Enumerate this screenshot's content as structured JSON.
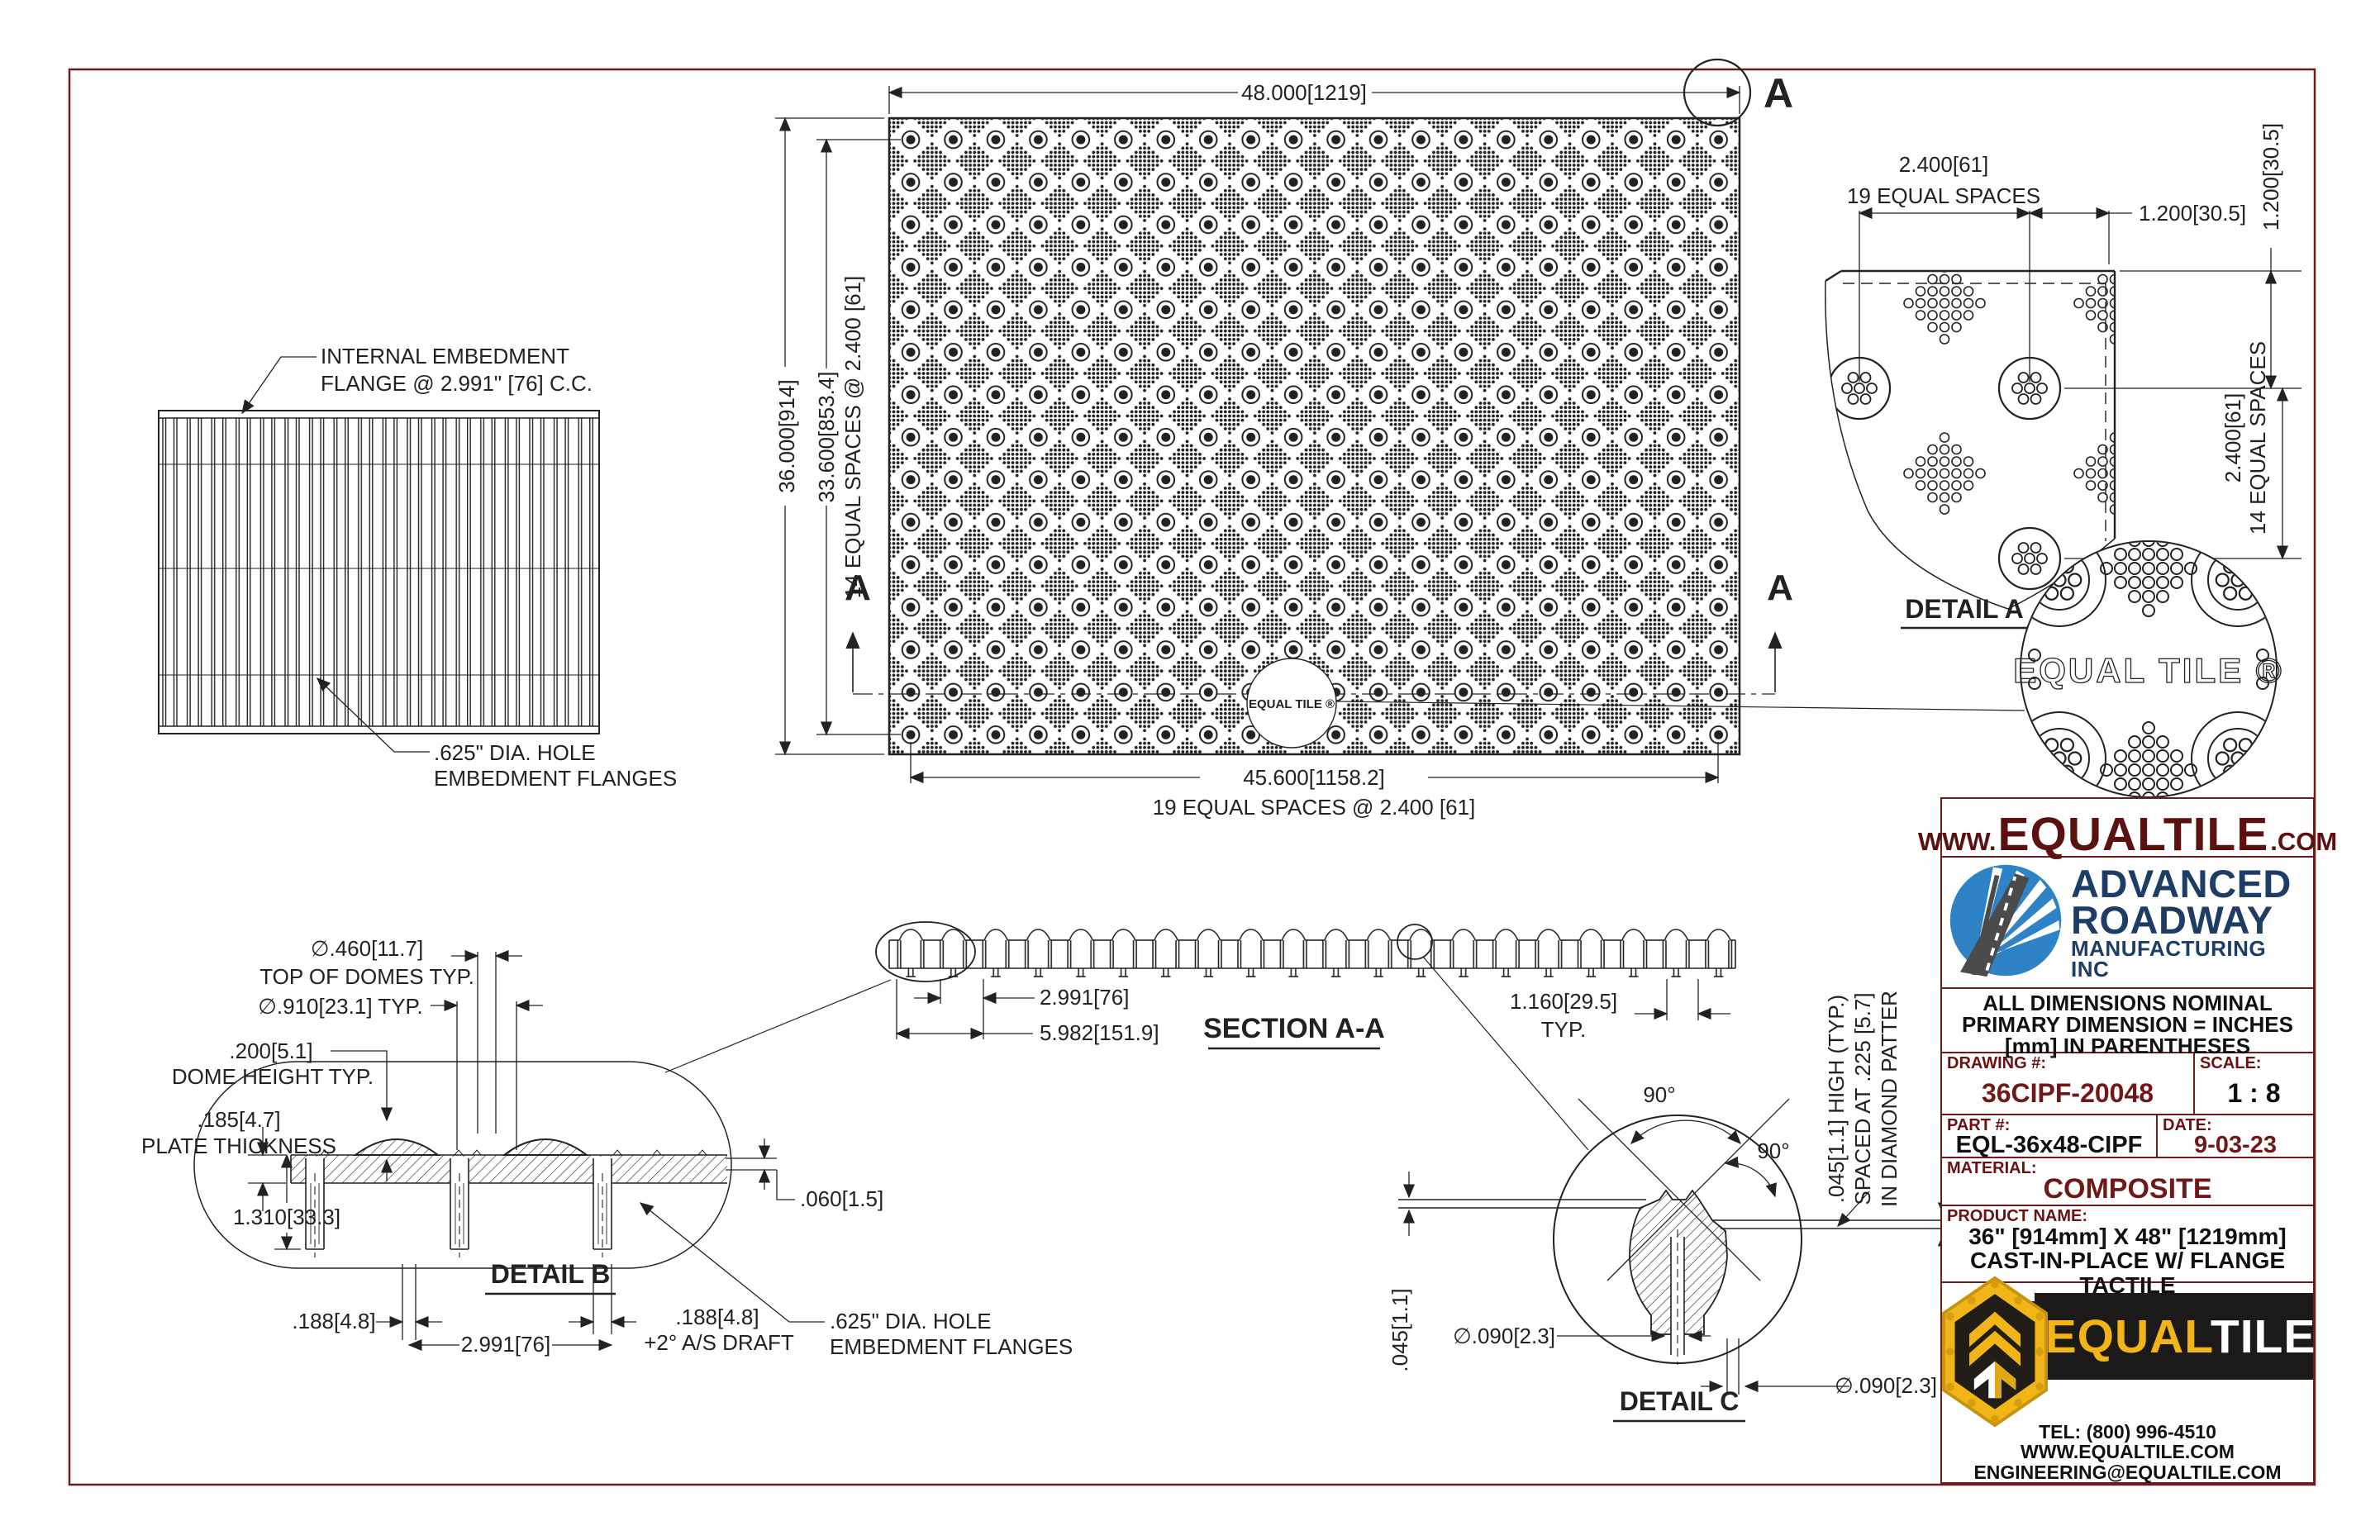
{
  "colors": {
    "sheet_border": "#6e1b1b",
    "line": "#222222",
    "url_red": "#5c1111",
    "value_red": "#701717",
    "navy": "#1d3c66",
    "logo_blue": "#2d83c5",
    "brand_yellow": "#f2b517",
    "banner_black": "#1c1a18"
  },
  "side_view": {
    "note1": "INTERNAL EMBEDMENT",
    "note2": "FLANGE @ 2.991\" [76] C.C.",
    "hole1": ".625\" DIA. HOLE",
    "hole2": "EMBEDMENT FLANGES"
  },
  "plan": {
    "width": "48.000[1219]",
    "height": "36.000[914]",
    "height_inner": "33.600[853.4]",
    "v_spaces": "14 EQUAL SPACES @ 2.400 [61]",
    "width_inner": "45.600[1158.2]",
    "h_spaces": "19 EQUAL SPACES @ 2.400 [61]",
    "marker": "A",
    "logo_stamp": "EQUAL TILE ®"
  },
  "detail_a": {
    "title": "DETAIL A",
    "pitch": "2.400[61]",
    "spaces19": "19 EQUAL SPACES",
    "offset": "1.200[30.5]",
    "offset_v": "1.200[30.5]",
    "pitch_v": "2.400[61]",
    "spaces14": "14 EQUAL SPACES"
  },
  "logo_detail": {
    "text": "EQUAL TILE ®"
  },
  "section_aa": {
    "title": "SECTION A-A",
    "dim_pitch": "2.991[76]",
    "dim_double": "5.982[151.9]",
    "dim_gap": "1.160[29.5]",
    "typ": "TYP."
  },
  "detail_b": {
    "title": "DETAIL B",
    "dome_top": "∅.460[11.7]",
    "dome_top_note": "TOP OF DOMES TYP.",
    "dome_base": "∅.910[23.1] TYP.",
    "dome_h": ".200[5.1]",
    "dome_h_note": "DOME HEIGHT TYP.",
    "plate": ".185[4.7]",
    "plate_note": "PLATE THICKNESS",
    "depth": "1.310[33.3]",
    "step": ".060[1.5]",
    "flange_t": ".188[4.8]",
    "pitch": "2.991[76]",
    "flange_t2": ".188[4.8]",
    "draft": "+2° A/S DRAFT",
    "hole1": ".625\" DIA. HOLE",
    "hole2": "EMBEDMENT FLANGES"
  },
  "detail_c": {
    "title": "DETAIL C",
    "angle1": "90°",
    "angle2": "90°",
    "height": ".045[1.1]",
    "dia1": "∅.090[2.3]",
    "dia2": "∅.090[2.3]",
    "rot1": ".045[1.1] HIGH (TYP.)",
    "rot2": "SPACED AT .225 [5.7]",
    "rot3": "IN DIAMOND PATTER"
  },
  "title_block": {
    "url": {
      "www": "WWW.",
      "name": "EQUALTILE",
      "com": ".COM"
    },
    "company": {
      "line1": "ADVANCED",
      "line2": "ROADWAY",
      "line3": "MANUFACTURING INC"
    },
    "notes": [
      "ALL DIMENSIONS NOMINAL",
      "PRIMARY DIMENSION = INCHES",
      "[mm] IN PARENTHESES"
    ],
    "fields": {
      "drawing_label": "DRAWING #:",
      "drawing_value": "36CIPF-20048",
      "scale_label": "SCALE:",
      "scale_value": "1 : 8",
      "part_label": "PART #:",
      "part_value": "EQL-36x48-CIPF",
      "date_label": "DATE:",
      "date_value": "9-03-23",
      "material_label": "MATERIAL:",
      "material_value": "COMPOSITE",
      "product_label": "PRODUCT NAME:",
      "product_lines": [
        "36\" [914mm] X 48\" [1219mm]",
        "CAST-IN-PLACE W/ FLANGE TACTILE",
        "WARNING SURFACE"
      ]
    },
    "brand": {
      "name_left": "EQUAL",
      "name_right": "TILE",
      "tel": "TEL: (800) 996-4510",
      "web": "WWW.EQUALTILE.COM",
      "email": "ENGINEERING@EQUALTILE.COM"
    }
  }
}
